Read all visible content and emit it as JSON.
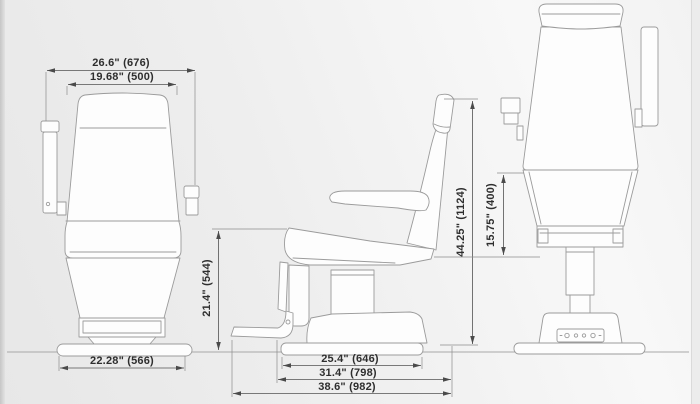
{
  "diagram": {
    "description": "three-view dimensioned drawing of a medical exam chair",
    "dimensions": {
      "front_overall_width": "26.6\" (676)",
      "front_seat_width": "19.68\" (500)",
      "front_base_width": "22.28\" (566)",
      "seat_height": "21.4\" (544)",
      "base_plate_length": "25.4\" (646)",
      "base_length": "31.4\" (798)",
      "overall_length": "38.6\" (982)",
      "overall_height": "44.25\" (1124)",
      "backrest_height": "15.75\" (400)"
    },
    "colors": {
      "line": "#9b9b9b",
      "dimension_line": "#525252",
      "text": "#2e2e2e",
      "background_left": "#e7e7e7",
      "background_right": "#f8f8f8"
    }
  }
}
